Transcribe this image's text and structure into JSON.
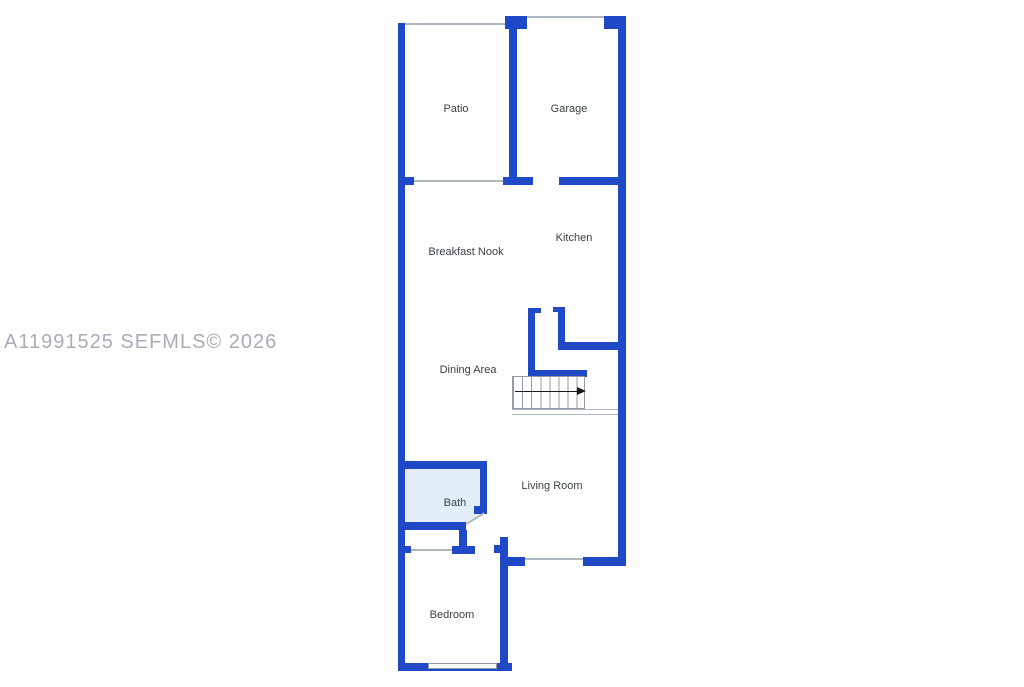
{
  "watermark": "A11991525 SEFMLS© 2026",
  "rooms": {
    "patio": "Patio",
    "garage": "Garage",
    "kitchen": "Kitchen",
    "breakfast_nook": "Breakfast Nook",
    "dining_area": "Dining Area",
    "living_room": "Living Room",
    "bath": "Bath",
    "bedroom": "Bedroom"
  },
  "icons": {
    "stairs_direction_arrow": "right-arrow"
  },
  "colors": {
    "background": "#ffffff",
    "wall": "#2049c8",
    "bath_fill": "#e4eef9",
    "thin_line": "#aeb6c0",
    "stairs_line": "#939ba6",
    "arrow": "#1a1a1a",
    "label": "#3b4248",
    "watermark": "#a8adb8"
  }
}
